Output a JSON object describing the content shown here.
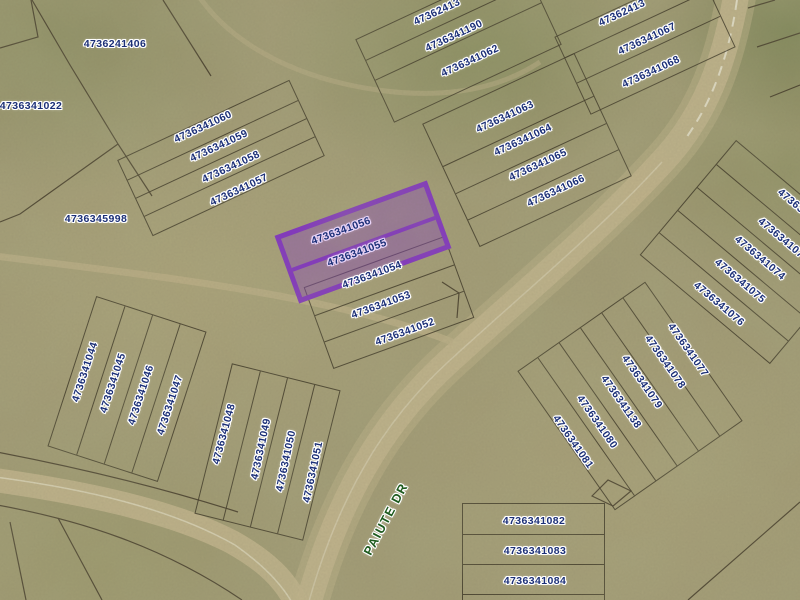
{
  "map": {
    "type": "parcel-map-aerial",
    "terrain": {
      "base_color": "#a39b75",
      "road_color": "#c8b78f",
      "boundary_line_color": "#362b1d"
    },
    "label_style": {
      "text_color": "#1b2f77",
      "halo_color": "#ffffff"
    },
    "street": {
      "name": "PAIUTE DR",
      "color": "#1d5a1d"
    },
    "highlight": {
      "parcel_ids": [
        "4736341056",
        "4736341055"
      ],
      "border_color": "#7d1fd0",
      "fill_color": "rgba(128,40,210,0.42)"
    },
    "parcel_labels": [
      {
        "id": "4736241406",
        "x": 115,
        "y": 44,
        "rot": 0
      },
      {
        "id": "4736341022",
        "x": 31,
        "y": 106,
        "rot": 0
      },
      {
        "id": "4736345998",
        "x": 96,
        "y": 219,
        "rot": 0
      },
      {
        "id": "4736341060",
        "x": 203,
        "y": 127,
        "rot": -25
      },
      {
        "id": "4736341059",
        "x": 219,
        "y": 146,
        "rot": -25
      },
      {
        "id": "4736341058",
        "x": 231,
        "y": 167,
        "rot": -25
      },
      {
        "id": "4736341057",
        "x": 239,
        "y": 190,
        "rot": -25
      },
      {
        "id": "47362413",
        "x": 437,
        "y": 12,
        "rot": -25
      },
      {
        "id": "4736341190",
        "x": 454,
        "y": 36,
        "rot": -25
      },
      {
        "id": "4736341062",
        "x": 470,
        "y": 61,
        "rot": -25
      },
      {
        "id": "4736341063",
        "x": 505,
        "y": 117,
        "rot": -25
      },
      {
        "id": "4736341064",
        "x": 523,
        "y": 140,
        "rot": -25
      },
      {
        "id": "4736341065",
        "x": 538,
        "y": 165,
        "rot": -25
      },
      {
        "id": "4736341066",
        "x": 556,
        "y": 191,
        "rot": -25
      },
      {
        "id": "47362413",
        "x": 622,
        "y": 13,
        "rot": -25
      },
      {
        "id": "4736341067",
        "x": 647,
        "y": 39,
        "rot": -25
      },
      {
        "id": "4736341068",
        "x": 651,
        "y": 72,
        "rot": -25
      },
      {
        "id": "47363",
        "x": 791,
        "y": 201,
        "rot": 40
      },
      {
        "id": "473634107",
        "x": 781,
        "y": 238,
        "rot": 40
      },
      {
        "id": "4736341074",
        "x": 760,
        "y": 258,
        "rot": 40
      },
      {
        "id": "4736341075",
        "x": 740,
        "y": 281,
        "rot": 40
      },
      {
        "id": "4736341076",
        "x": 719,
        "y": 304,
        "rot": 40
      },
      {
        "id": "4736341077",
        "x": 688,
        "y": 350,
        "rot": 55
      },
      {
        "id": "4736341078",
        "x": 665,
        "y": 362,
        "rot": 55
      },
      {
        "id": "4736341079",
        "x": 642,
        "y": 382,
        "rot": 55
      },
      {
        "id": "4736341138",
        "x": 621,
        "y": 402,
        "rot": 55
      },
      {
        "id": "4736341080",
        "x": 597,
        "y": 422,
        "rot": 55
      },
      {
        "id": "4736341081",
        "x": 573,
        "y": 442,
        "rot": 55
      },
      {
        "id": "4736341056",
        "x": 341,
        "y": 231,
        "rot": -20,
        "hl": true
      },
      {
        "id": "4736341055",
        "x": 357,
        "y": 253,
        "rot": -20,
        "hl": true
      },
      {
        "id": "4736341054",
        "x": 372,
        "y": 275,
        "rot": -20
      },
      {
        "id": "4736341053",
        "x": 381,
        "y": 305,
        "rot": -20
      },
      {
        "id": "4736341052",
        "x": 405,
        "y": 332,
        "rot": -20
      },
      {
        "id": "4736341044",
        "x": 85,
        "y": 372,
        "rot": -72
      },
      {
        "id": "4736341045",
        "x": 113,
        "y": 383,
        "rot": -72
      },
      {
        "id": "4736341046",
        "x": 141,
        "y": 395,
        "rot": -72
      },
      {
        "id": "4736341047",
        "x": 170,
        "y": 405,
        "rot": -72
      },
      {
        "id": "4736341048",
        "x": 224,
        "y": 434,
        "rot": -75
      },
      {
        "id": "4736341049",
        "x": 261,
        "y": 449,
        "rot": -78
      },
      {
        "id": "4736341050",
        "x": 286,
        "y": 461,
        "rot": -78
      },
      {
        "id": "4736341051",
        "x": 313,
        "y": 472,
        "rot": -78
      },
      {
        "id": "4736341082",
        "x": 534,
        "y": 521,
        "rot": 0
      },
      {
        "id": "4736341083",
        "x": 535,
        "y": 551,
        "rot": 0
      },
      {
        "id": "4736341084",
        "x": 535,
        "y": 581,
        "rot": 0
      }
    ]
  }
}
